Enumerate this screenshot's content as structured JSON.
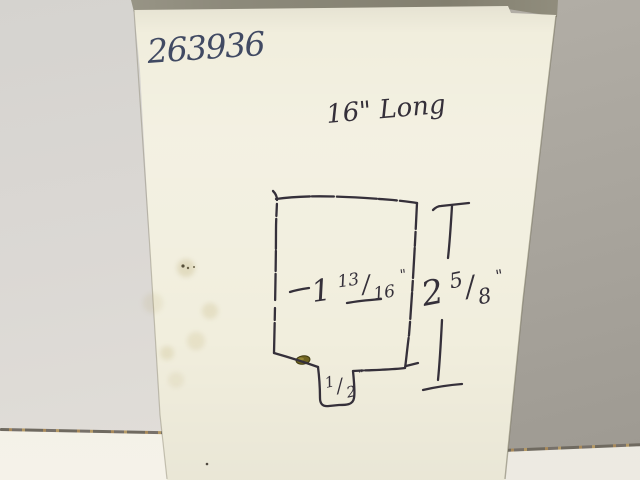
{
  "handwriting": {
    "part_number": "263936",
    "length_note": "16\" Long",
    "width": {
      "whole": "1",
      "numerator": "13",
      "slash": "/",
      "denominator": "16",
      "unit": "\"",
      "full_text": "1 13/16\""
    },
    "height": {
      "whole": "2",
      "numerator": "5",
      "slash": "/",
      "denominator": "8",
      "unit": "\"",
      "full_text": "2 5/8\""
    },
    "tab": {
      "numerator": "1",
      "slash": "/",
      "denominator": "2",
      "unit": "\"",
      "full_text": "1/2\""
    }
  },
  "colors": {
    "pen_ink": "#414a63",
    "sketch_ink": "#35303a",
    "paper": "#f1eedd",
    "wall_left": "#dbd8d4",
    "wall_right": "#a9a59d",
    "table_left": "#f2efe6",
    "table_right": "#e9e6de",
    "stain_olive": "#6f6320"
  }
}
